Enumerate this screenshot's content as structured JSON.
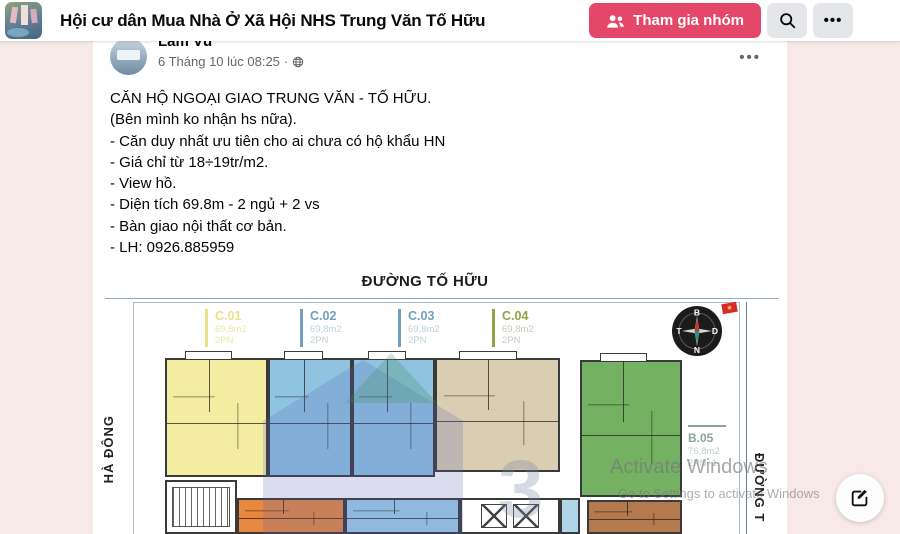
{
  "page_bg": "#f6e9e7",
  "header": {
    "group_title": "Hội cư dân Mua Nhà Ở Xã Hội NHS Trung Văn Tố Hữu",
    "join_label": "Tham gia nhóm",
    "accent_color": "#e54768",
    "search_icon": "magnifier",
    "more_glyph": "•••"
  },
  "post": {
    "author": "Lâm Vũ",
    "timestamp": "6 Tháng 10 lúc 08:25",
    "meta_separator": "·",
    "visibility_icon": "globe",
    "more_glyph": "•••",
    "lines": [
      "CĂN HỘ NGOẠI GIAO TRUNG VĂN - TỐ HỮU.",
      "(Bên mình ko nhận hs nữa).",
      "- Căn duy nhất ưu tiên cho ai chưa có hộ khẩu HN",
      "- Giá chỉ từ 18÷19tr/m2.",
      "- View hồ.",
      "- Diện tích 69.8m - 2 ngủ + 2 vs",
      "- Bàn giao nội thất cơ bản.",
      "- LH: 0926.885959"
    ]
  },
  "floorplan": {
    "street_top": "ĐƯỜNG TỐ HỮU",
    "street_left": "HÀ ĐÔNG",
    "street_right": "ĐƯỜNG T",
    "watermark_number": "3",
    "compass": {
      "north": "B",
      "east": "D",
      "south": "N",
      "west": "T"
    },
    "flag_star": "★",
    "units": [
      {
        "id": "C.01",
        "area": "69,8m2",
        "beds": "2PN",
        "fill": "#f2eda0",
        "label": "#eae189",
        "sub": "#ece7a8"
      },
      {
        "id": "C.02",
        "area": "69,8m2",
        "beds": "2PN",
        "fill": "#8fc3e0",
        "label": "#709fc0",
        "sub": "#bccfdb"
      },
      {
        "id": "C.03",
        "area": "69,8m2",
        "beds": "2PN",
        "fill": "#8fc3e0",
        "label": "#709fc0",
        "sub": "#bccfdb"
      },
      {
        "id": "C.04",
        "area": "69,8m2",
        "beds": "2PN",
        "fill": "#d9cdb2",
        "label": "#98a148",
        "sub": "#c6cab8"
      },
      {
        "id": "B.05",
        "area": "76,8m2",
        "beds": "2PN+1",
        "fill": "#74b163",
        "label": "#8aa596",
        "sub": "#c2ccc5"
      }
    ],
    "unlabeled_fills": {
      "orange": "#e8883f",
      "blue_bottom": "#9fd2e8",
      "blue_strip": "#aed6e8",
      "brown": "#b5794e"
    }
  },
  "windows_watermark": {
    "line1": "Activate Windows",
    "line2": "Go to Settings to activate Windows"
  }
}
